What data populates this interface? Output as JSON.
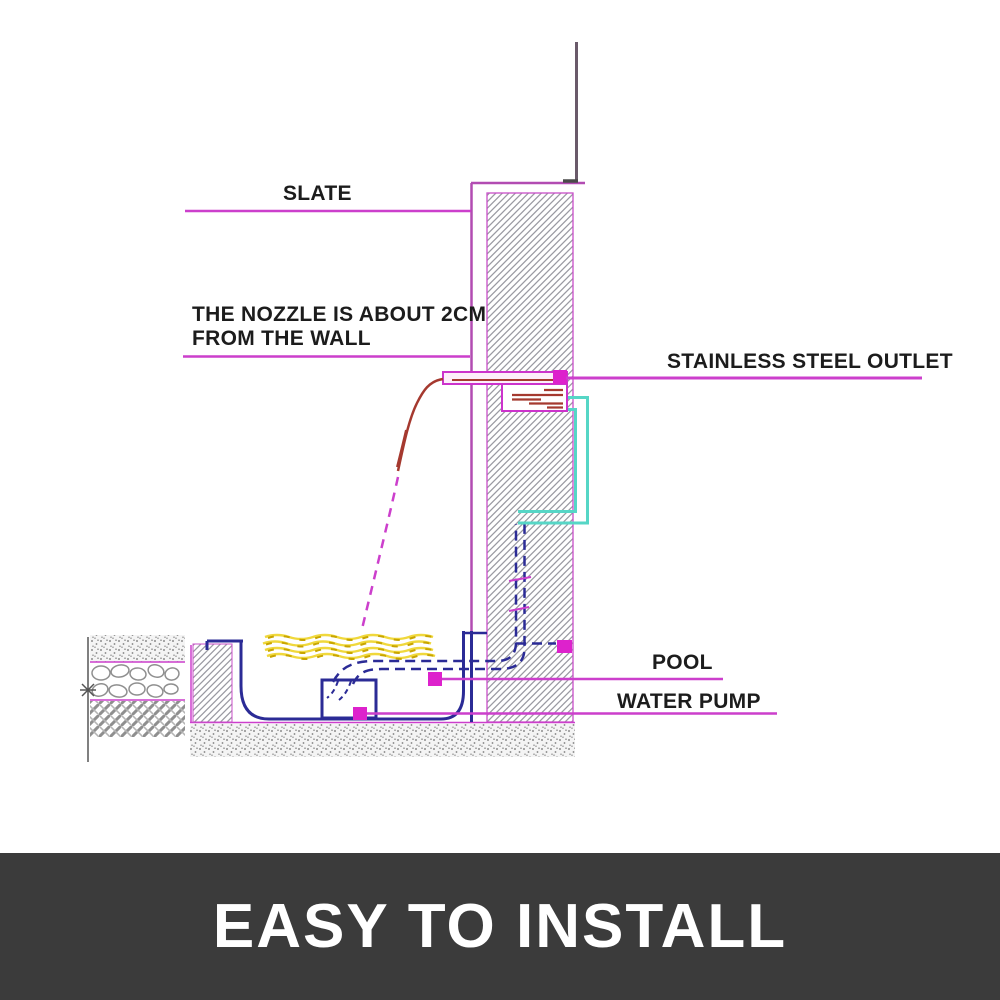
{
  "diagram": {
    "labels": {
      "slate": "SLATE",
      "nozzle_line1": "THE NOZZLE IS ABOUT 2CM",
      "nozzle_line2": "FROM THE WALL",
      "outlet": "STAINLESS STEEL OUTLET",
      "pool": "POOL",
      "water_pump": "WATER PUMP"
    }
  },
  "banner": {
    "title": "EASY TO INSTALL"
  },
  "colors": {
    "leader_magenta": "#cc3fcc",
    "dot_magenta": "#dd22cc",
    "structure_purple": "#b24cb2",
    "pole_gray": "#6a5a6a",
    "pipe_navy": "#2b2b96",
    "hose_teal": "#56d6c6",
    "stream_red": "#a5392f",
    "water_yellow": "#f0d83c",
    "water_yellow_dark": "#c8a500",
    "hatch_gray": "#9a9aa2",
    "banner_bg": "#3b3b3b",
    "banner_text": "#ffffff",
    "label_text": "#1c1c1c"
  }
}
